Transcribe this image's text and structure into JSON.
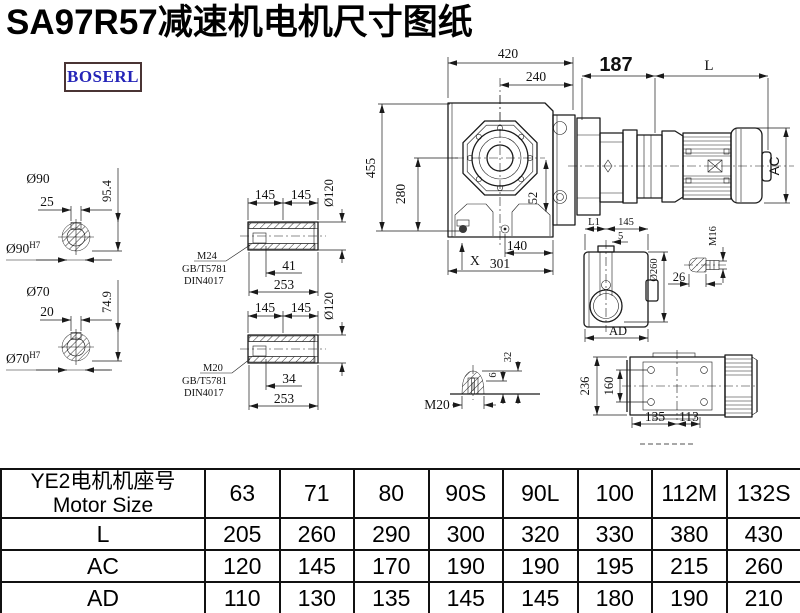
{
  "title": "SA97R57减速机电机尺寸图纸",
  "brand": {
    "logo_text": "BOSERL"
  },
  "drawing": {
    "shaft_section_90": {
      "dia": "Ø90",
      "keyway_width": "25",
      "height": "95.4",
      "bore": "Ø90",
      "bore_fit": "H7"
    },
    "shaft_section_70": {
      "dia": "Ø70",
      "keyway_width": "20",
      "height": "74.9",
      "bore": "Ø70",
      "bore_fit": "H7"
    },
    "sleeve_m24": {
      "len_a": "145",
      "len_b": "145",
      "dia": "Ø120",
      "thread": "M24",
      "std_gb": "GB/T5781",
      "std_din": "DIN4017",
      "depth": "41",
      "total_len": "253"
    },
    "sleeve_m20": {
      "len_a": "145",
      "len_b": "145",
      "dia": "Ø120",
      "thread": "M20",
      "std_gb": "GB/T5781",
      "std_din": "DIN4017",
      "depth": "34",
      "total_len": "253"
    },
    "front_view": {
      "width_top": "420",
      "width_inner": "240",
      "height": "455",
      "height_inner": "280",
      "offset": "52",
      "base_a": "140",
      "base_b": "301",
      "mark_x": "X"
    },
    "motor_view": {
      "len_adapter": "187",
      "len_motor": "L",
      "dia_motor": "AC"
    },
    "side_view": {
      "dim_l1": "L1",
      "dim_145": "145",
      "dim_5": "5",
      "dia": "Ø260",
      "dim_ad": "AD"
    },
    "plug_m16": {
      "thread": "M16",
      "len": "26"
    },
    "plug_m20": {
      "thread": "M20",
      "tip": "6",
      "height": "32"
    },
    "top_view": {
      "height": "236",
      "bolt_span": "160",
      "len_a": "135",
      "len_b": "113"
    }
  },
  "table": {
    "header_line1": "YE2电机机座号",
    "header_line2": "Motor Size",
    "columns": [
      "63",
      "71",
      "80",
      "90S",
      "90L",
      "100",
      "112M",
      "132S"
    ],
    "rows": [
      {
        "label": "L",
        "values": [
          "205",
          "260",
          "290",
          "300",
          "320",
          "330",
          "380",
          "430"
        ]
      },
      {
        "label": "AC",
        "values": [
          "120",
          "145",
          "170",
          "190",
          "190",
          "195",
          "215",
          "260"
        ]
      },
      {
        "label": "AD",
        "values": [
          "110",
          "130",
          "135",
          "145",
          "145",
          "180",
          "190",
          "210"
        ]
      }
    ]
  }
}
